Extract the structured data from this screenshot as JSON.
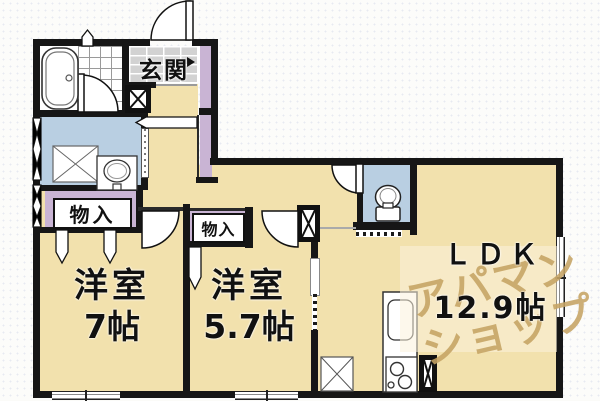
{
  "plan": {
    "entrance": {
      "label": "玄関"
    },
    "storage_left": {
      "label": "物入"
    },
    "storage_right": {
      "label": "物入"
    },
    "bedroom_left": {
      "name": "洋室",
      "size": "7帖"
    },
    "bedroom_middle": {
      "name": "洋室",
      "size": "5.7帖"
    },
    "ldk": {
      "name": "ＬＤＫ",
      "size": "12.9帖"
    }
  },
  "watermark": {
    "line1": "アパマン",
    "line2": "ショップ"
  },
  "colors": {
    "floor": "#f2e1ad",
    "wet_area": "#b9cfe2",
    "storage": "#c9b4d4",
    "entrance_tile": "#d2d2d2",
    "wall": "#161616",
    "watermark_text": "#c5a363",
    "watermark_panel": "#fcf3dd"
  },
  "icons": {
    "bathtub": "bathtub-icon",
    "toilet": "toilet-icon",
    "washbasin": "washbasin-icon",
    "kitchen_sink": "kitchen-sink-icon",
    "stove": "stove-burners-icon",
    "washing_machine_space": "crossed-square",
    "refrigerator_space": "crossed-square",
    "pipe_shaft": "black-crossed-box",
    "door": "quarter-arc",
    "closet_door": "dart"
  }
}
